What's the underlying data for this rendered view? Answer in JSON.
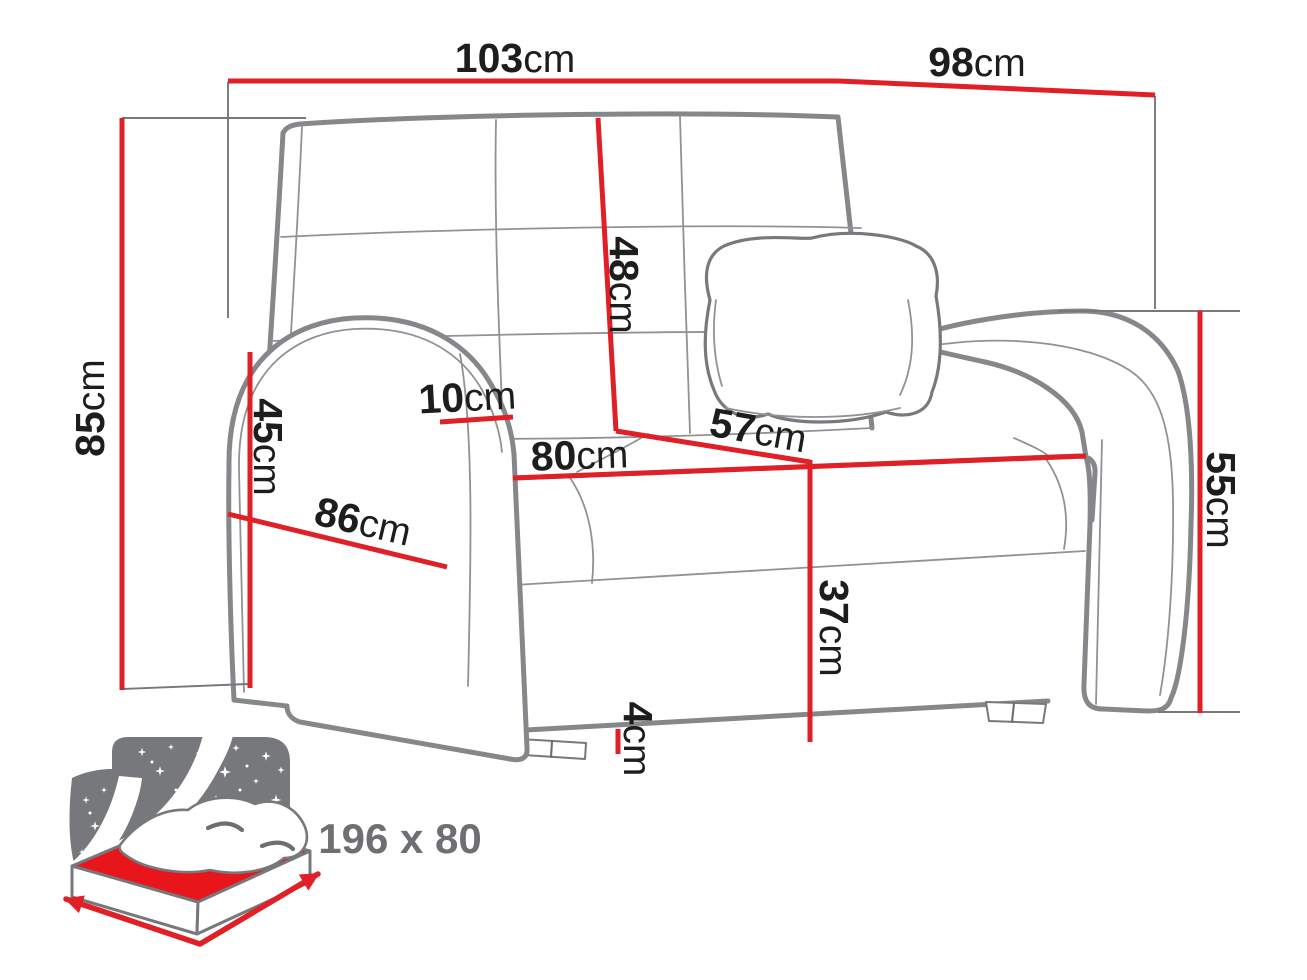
{
  "diagram": {
    "type": "furniture-dimension-diagram",
    "subject": "armchair sofa-bed with pillow",
    "dimensions": [
      {
        "id": "overall-width",
        "value": "103",
        "unit": "cm"
      },
      {
        "id": "overall-depth",
        "value": "98",
        "unit": "cm"
      },
      {
        "id": "overall-height",
        "value": "85",
        "unit": "cm"
      },
      {
        "id": "backrest-height",
        "value": "48",
        "unit": "cm"
      },
      {
        "id": "armrest-width",
        "value": "10",
        "unit": "cm"
      },
      {
        "id": "armrest-front-height",
        "value": "45",
        "unit": "cm"
      },
      {
        "id": "seat-width",
        "value": "80",
        "unit": "cm"
      },
      {
        "id": "seat-depth",
        "value": "57",
        "unit": "cm"
      },
      {
        "id": "side-depth",
        "value": "86",
        "unit": "cm"
      },
      {
        "id": "seat-height",
        "value": "37",
        "unit": "cm"
      },
      {
        "id": "leg-height",
        "value": "4",
        "unit": "cm"
      },
      {
        "id": "armrest-outer-height",
        "value": "55",
        "unit": "cm"
      }
    ],
    "sleeping_area": {
      "icon": "sofa-bed-sleeping-size-icon",
      "label": "196 x 80"
    },
    "colors": {
      "dimension_red": "#e01f26",
      "outline_gray": "#85878a",
      "icon_gray": "#77787b",
      "label_black": "#1d1d1b",
      "size_label_gray": "#6d6f72",
      "background": "#ffffff"
    }
  }
}
